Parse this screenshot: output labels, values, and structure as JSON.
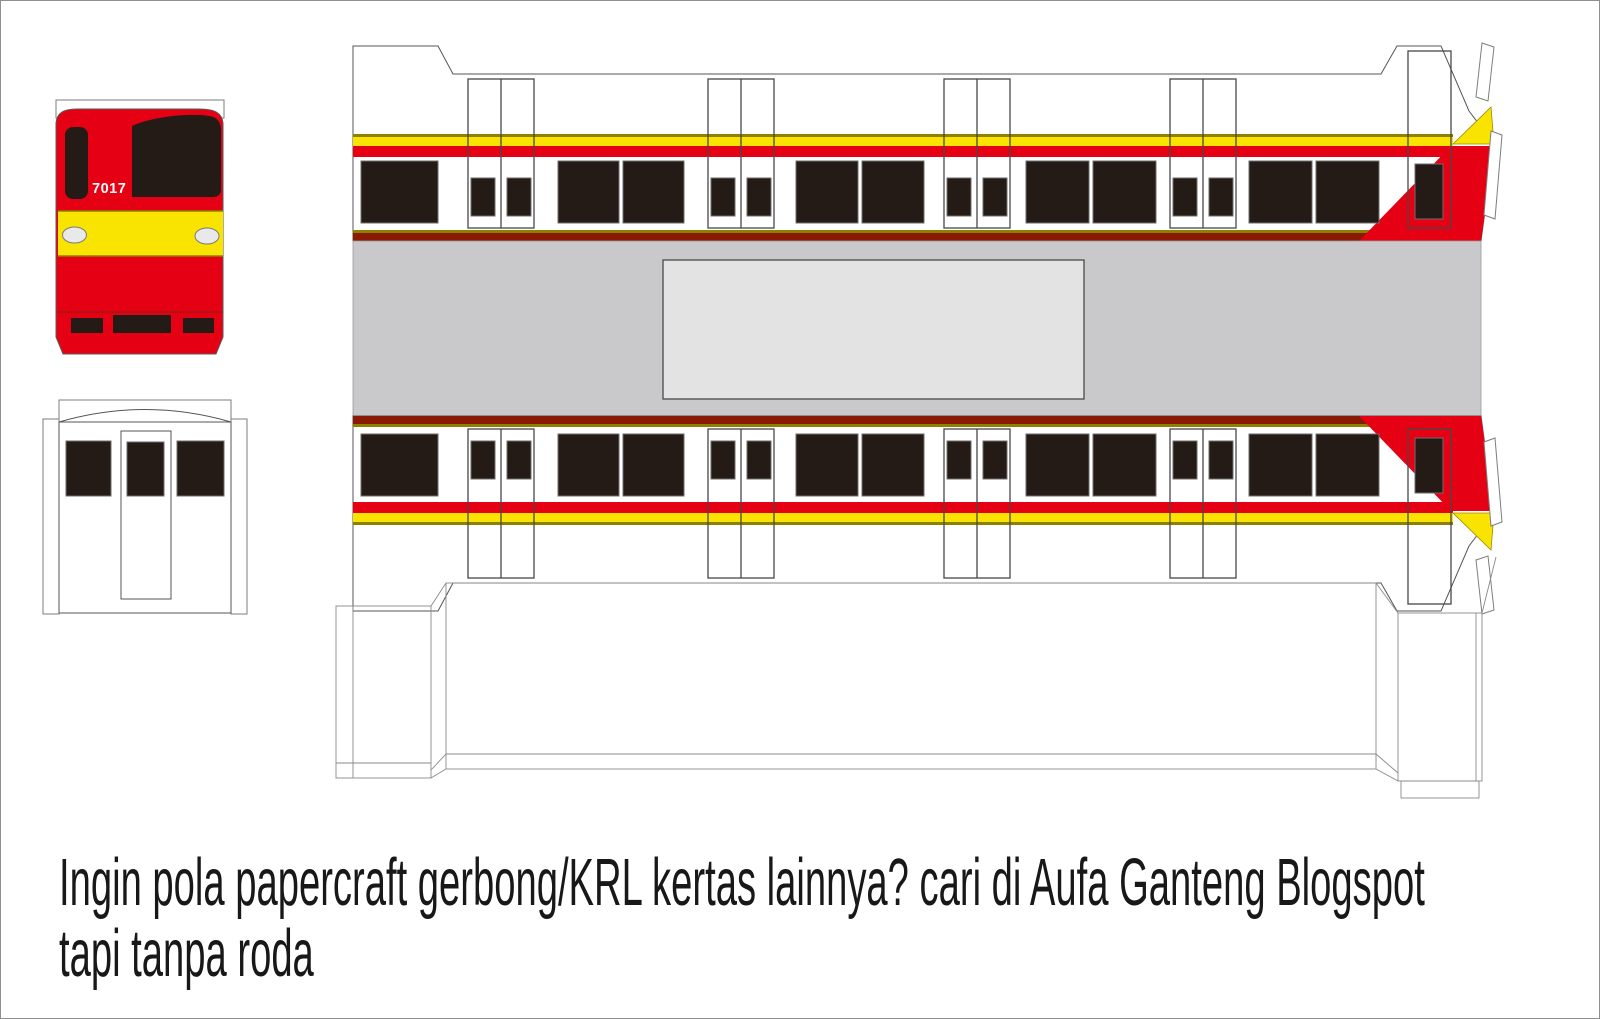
{
  "colors": {
    "red": "#e60014",
    "yellow": "#f8e400",
    "olive": "#8f8000",
    "dark_red": "#8a1a05",
    "window": "#241a16",
    "roof_gray": "#c9c9cb",
    "roof_panel": "#e3e3e4",
    "headlight": "#e9e9e9",
    "outline": "#555555"
  },
  "front_view": {
    "train_number": "7017"
  },
  "caption": {
    "line1": "Ingin pola papercraft gerbong/KRL kertas lainnya? cari di Aufa Ganteng Blogspot",
    "line2": "tapi tanpa roda"
  }
}
